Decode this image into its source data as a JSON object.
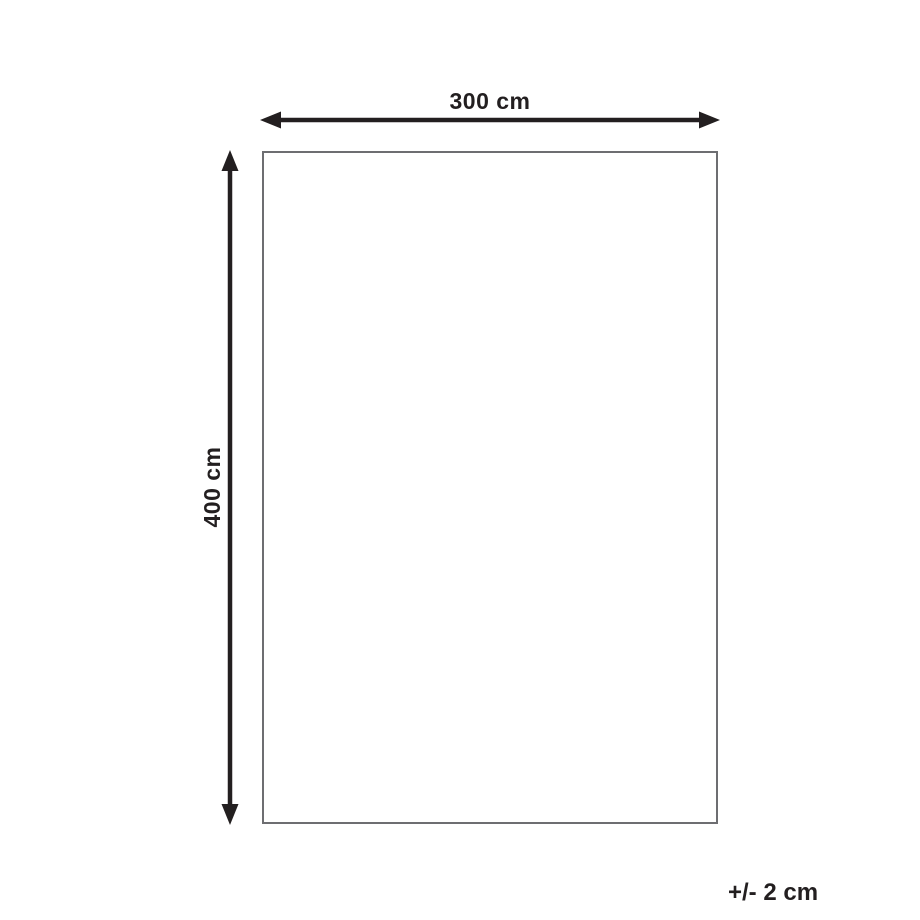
{
  "diagram": {
    "type": "dimension-diagram",
    "shape": "rectangle",
    "width_label": "300 cm",
    "height_label": "400 cm",
    "tolerance_label": "+/- 2 cm",
    "dimensions": {
      "width_cm": 300,
      "height_cm": 400,
      "tolerance_cm": 2
    },
    "colors": {
      "background": "#ffffff",
      "arrow": "#231f20",
      "text": "#231f20",
      "rectangle_border": "#6d6e71",
      "rectangle_fill": "#ffffff"
    }
  }
}
